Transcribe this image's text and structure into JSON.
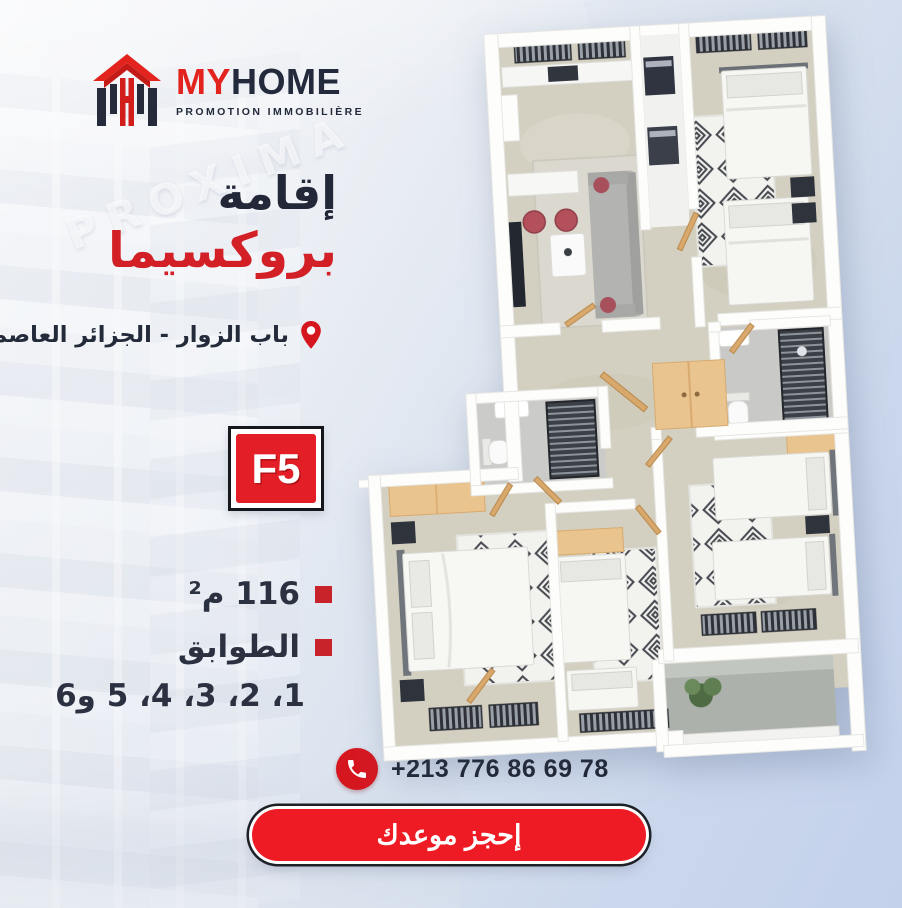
{
  "brand": {
    "name_red": "MY",
    "name_dark": "HOME",
    "tagline": "PROMOTION IMMOBILIÈRE",
    "colors": {
      "red": "#e2231e",
      "navy": "#232a3c",
      "cta_red": "#ee1b24",
      "badge_red": "#e31e26"
    }
  },
  "background": {
    "watermark": "PROXIMA"
  },
  "headline": {
    "line1": "إقامة",
    "line2": "بروكسيما"
  },
  "location": {
    "icon": "location-pin-icon",
    "text": "باب الزوار - الجزائر العاصمة"
  },
  "unit_badge": {
    "label": "F5"
  },
  "specs": [
    {
      "icon": "red-square-bullet",
      "label": "116 م²"
    },
    {
      "icon": "red-square-bullet",
      "label": "الطوابق"
    }
  ],
  "floors_line": "1، 2، 3، 4، 5 و6",
  "contact": {
    "icon": "phone-icon",
    "phone": "+213 776 86 69 78"
  },
  "cta": {
    "label": "إحجز موعدك"
  }
}
